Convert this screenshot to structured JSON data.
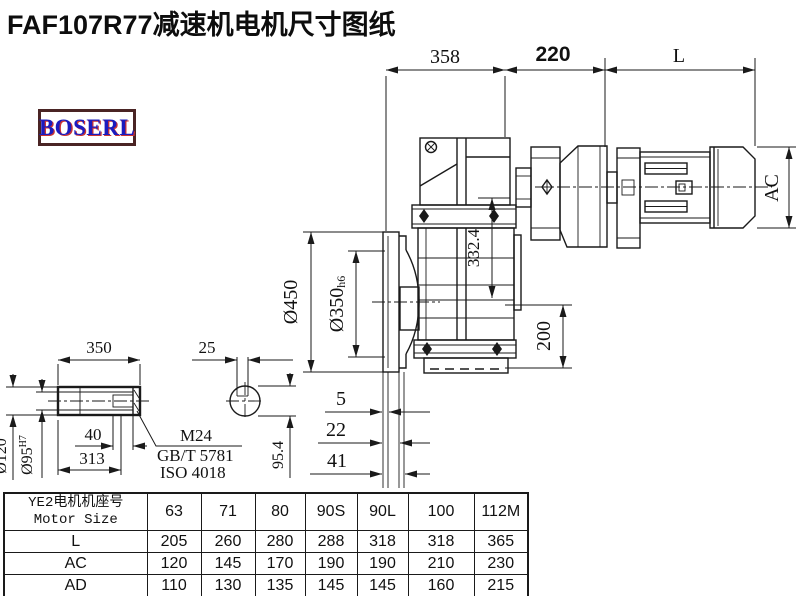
{
  "page": {
    "title": "FAF107R77减速机电机尺寸图纸"
  },
  "logo": {
    "text": "BOSERL"
  },
  "drawing": {
    "dim_gearbox_width": "358",
    "dim_adapter_width": "220",
    "dim_motor_length": "L",
    "dim_motor_diameter": "AC",
    "dim_center_height": "332.4",
    "dim_flange_od": "Ø450",
    "dim_spigot": "Ø350",
    "dim_spigot_tol": "h6",
    "dim_base_height": "200",
    "dim_offset_a": "5",
    "dim_offset_b": "22",
    "dim_offset_c": "41"
  },
  "shaft_detail": {
    "dim_length": "350",
    "dim_key_width": "25",
    "dim_od": "Ø120",
    "dim_bore": "Ø95",
    "dim_bore_tol": "H7",
    "dim_key_length": "40",
    "dim_insert_depth": "313",
    "dim_key_height": "95.4",
    "note_bolt": "M24",
    "note_std_gb": "GB/T 5781",
    "note_std_iso": "ISO 4018"
  },
  "table": {
    "header_cn": "YE2电机机座号",
    "header_en": "Motor Size",
    "columns": [
      "63",
      "71",
      "80",
      "90S",
      "90L",
      "100",
      "112M"
    ],
    "rows": [
      {
        "label": "L",
        "values": [
          "205",
          "260",
          "280",
          "288",
          "318",
          "318",
          "365"
        ]
      },
      {
        "label": "AC",
        "values": [
          "120",
          "145",
          "170",
          "190",
          "190",
          "210",
          "230"
        ]
      },
      {
        "label": "AD",
        "values": [
          "110",
          "130",
          "135",
          "145",
          "145",
          "160",
          "215"
        ]
      }
    ]
  }
}
